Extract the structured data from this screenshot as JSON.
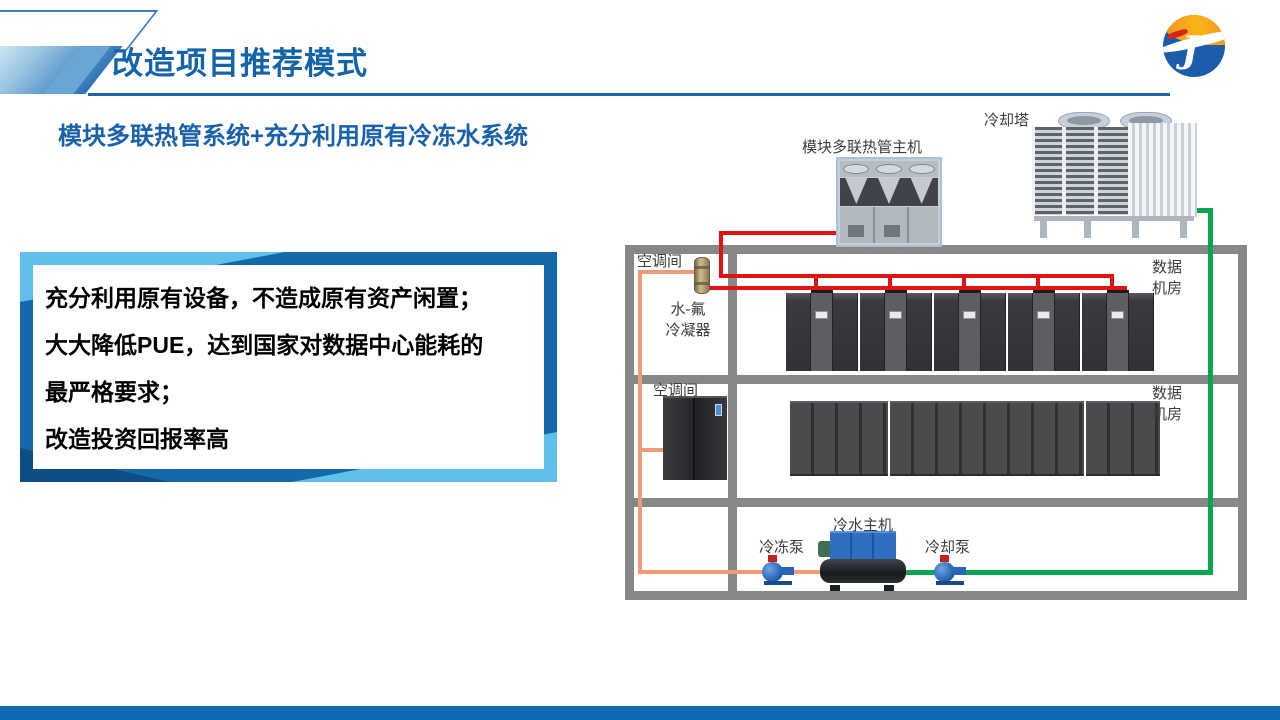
{
  "header": {
    "title": "改造项目推荐模式"
  },
  "subtitle": "模块多联热管系统+充分利用原有冷冻水系统",
  "info_box": {
    "lines": [
      "充分利用原有设备，不造成原有资产闲置；",
      "大大降低PUE，达到国家对数据中心能耗的",
      "最严格要求；",
      "改造投资回报率高"
    ]
  },
  "diagram": {
    "heat_pipe_host_label": "模块多联热管主机",
    "cooling_tower_label": "冷却塔",
    "ac_room_1_label": "空调间",
    "ac_room_2_label": "空调间",
    "condenser_label_line1": "水-氟",
    "condenser_label_line2": "冷凝器",
    "data_room_1_label_line1": "数据",
    "data_room_1_label_line2": "机房",
    "data_room_2_label_line1": "数据",
    "data_room_2_label_line2": "机房",
    "chilled_water_pump_label": "冷冻泵",
    "chiller_label": "冷水主机",
    "cooling_pump_label": "冷却泵",
    "colors": {
      "refrigerant_pipe_red": "#e11212",
      "chilled_water_pipe_orange": "#f09a78",
      "cooling_water_pipe_green": "#0aa550",
      "room_frame_gray": "#878787",
      "accent_blue_dark": "#1569a8",
      "accent_blue_light": "#5fc0ec"
    }
  }
}
